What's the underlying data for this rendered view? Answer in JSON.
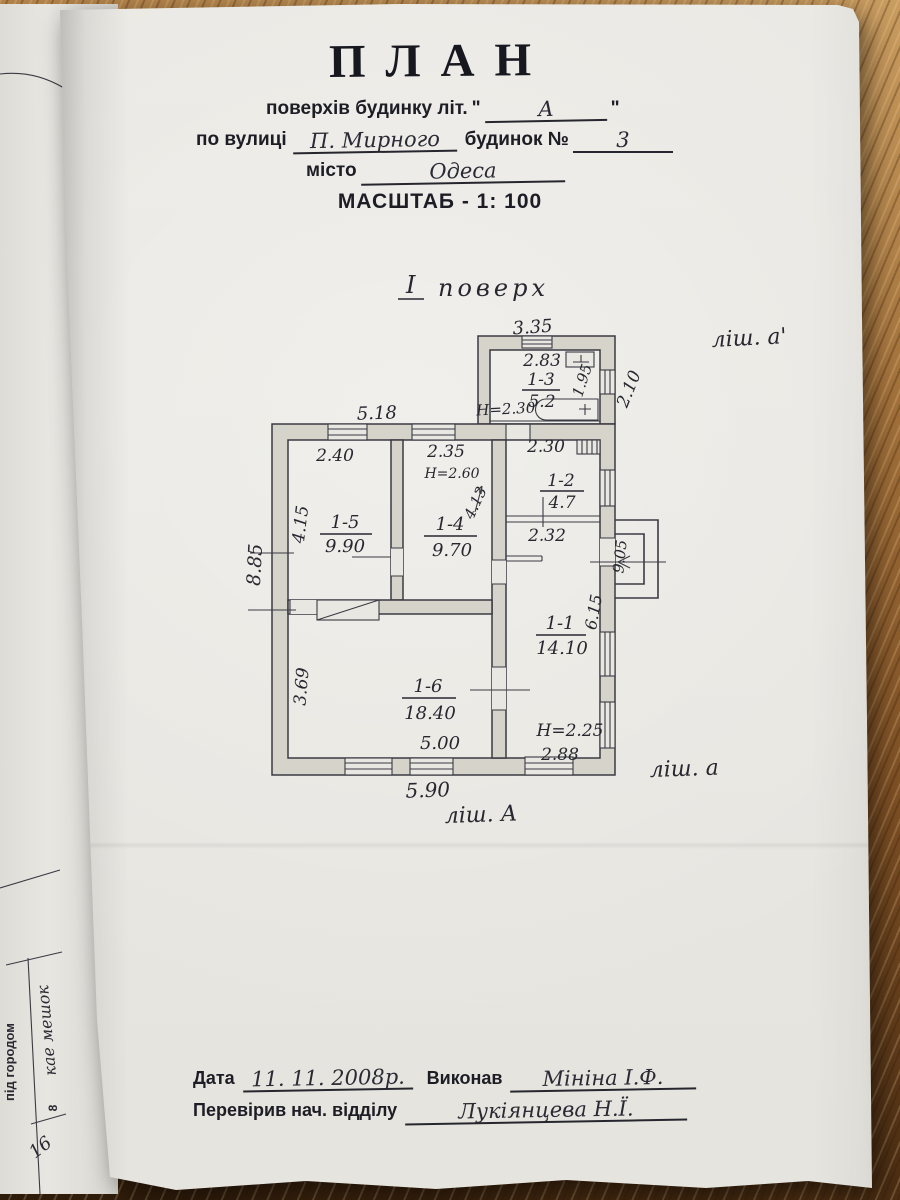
{
  "header": {
    "title": "ПЛАН",
    "storeys_label": "поверхів будинку літ.",
    "quote_open": "\"",
    "storeys_value": "А",
    "quote_close": "\"",
    "street_label": "по вулиці",
    "street_value": "П. Мирного",
    "house_label": "будинок №",
    "house_value": "3",
    "city_label": "місто",
    "city_value": "Одеса",
    "scale_label": "МАСШТАБ - 1: 100"
  },
  "plan": {
    "floor_roman": "І",
    "floor_word": "поверх",
    "lit_annex": "ліш. а'",
    "lit_right": "ліш. а",
    "lit_main": "ліш. А",
    "rooms": {
      "r13": {
        "id": "1-3",
        "area": "5.2"
      },
      "r12": {
        "id": "1-2",
        "area": "4.7"
      },
      "r15": {
        "id": "1-5",
        "area": "9.90"
      },
      "r14": {
        "id": "1-4",
        "area": "9.70"
      },
      "r11": {
        "id": "1-1",
        "area": "14.10"
      },
      "r16": {
        "id": "1-6",
        "area": "18.40"
      }
    },
    "dims": {
      "annex_top": "3.35",
      "annex_w": "2.83",
      "annex_h": "H=2.30",
      "annex_inner": "1.95",
      "right_upper": "2.10",
      "right_total": "9.05",
      "main_top": "5.18",
      "left_total": "8.85",
      "r15_w": "2.40",
      "r15_d": "4.15",
      "r14_w": "2.35",
      "r14_h": "H=2.60",
      "r14_d": "4.13",
      "r12_w": "2.30",
      "hall_w": "2.32",
      "r11_d": "6.15",
      "r11_h": "H=2.25",
      "r11_w": "2.88",
      "r16_d": "3.69",
      "r16_w": "5.00",
      "main_bottom": "5.90"
    }
  },
  "footer": {
    "date_label": "Дата",
    "date_value": "11. 11. 2008р.",
    "executor_label": "Виконав",
    "executor_value": "Мініна І.Ф.",
    "checker_label": "Перевірив нач. відділу",
    "checker_value": "Лукіянцева Н.Ї."
  },
  "side_page": {
    "printed_vertical": "під городом",
    "note_vertical": "кае мешок",
    "cell_number": "8",
    "page_number": "16"
  }
}
